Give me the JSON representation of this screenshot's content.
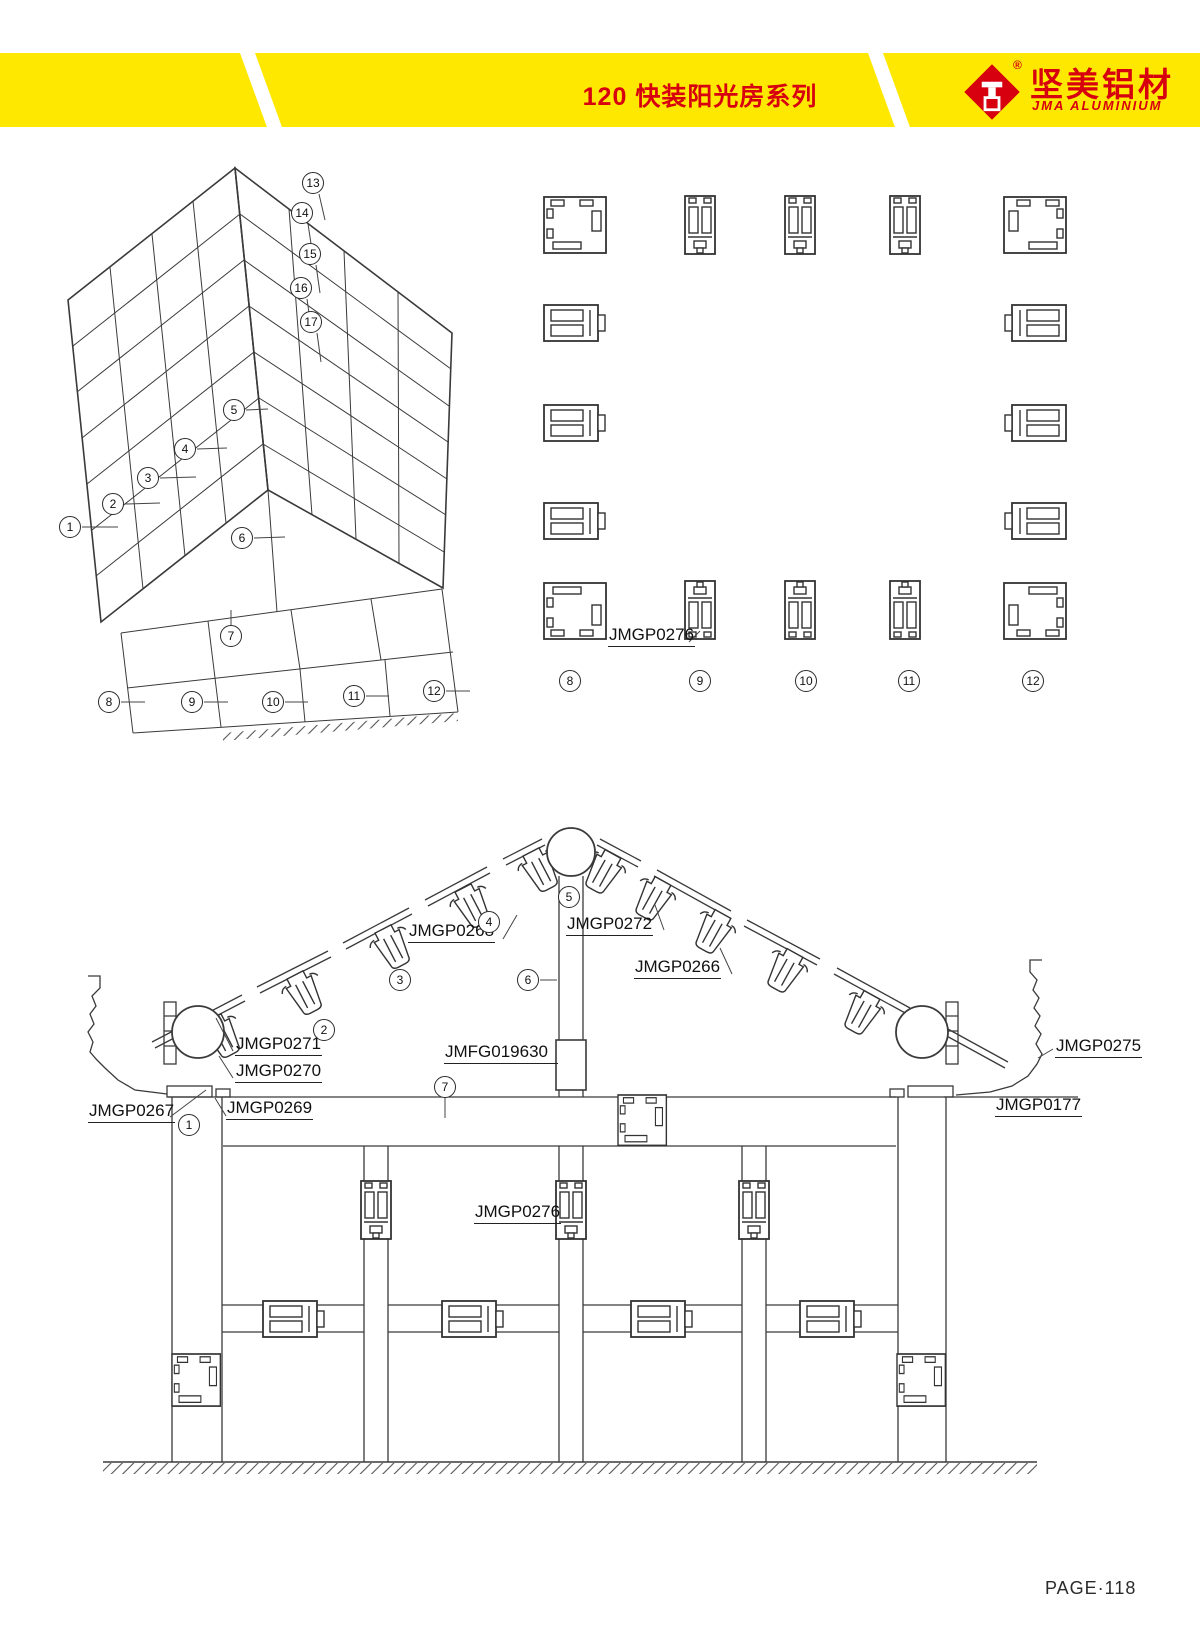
{
  "header": {
    "title": "120 快装阳光房系列",
    "logo": {
      "cn": "坚美铝材",
      "en": "JMA ALUMINIUM",
      "reg": "®"
    }
  },
  "footer": {
    "page": "PAGE·118"
  },
  "colors": {
    "accent_yellow": "#FFE800",
    "brand_red": "#D7000F",
    "line": "#3a3a3a"
  },
  "iso": {
    "callouts": {
      "c1": "1",
      "c2": "2",
      "c3": "3",
      "c4": "4",
      "c5": "5",
      "c6": "6",
      "c7": "7",
      "c8": "8",
      "c9": "9",
      "c10": "10",
      "c11": "11",
      "c12": "12",
      "c13": "13",
      "c14": "14",
      "c15": "15",
      "c16": "16",
      "c17": "17"
    }
  },
  "plan": {
    "part_label": "JMGP0276",
    "callouts": {
      "c8": "8",
      "c9": "9",
      "c10": "10",
      "c11": "11",
      "c12": "12"
    }
  },
  "section": {
    "labels": {
      "jmgp0268": "JMGP0268",
      "jmgp0272": "JMGP0272",
      "jmgp0266": "JMGP0266",
      "jmgp0271": "JMGP0271",
      "jmgp0270": "JMGP0270",
      "jmgp0267": "JMGP0267",
      "jmgp0269": "JMGP0269",
      "jmfg019630": "JMFG019630",
      "jmgp0275": "JMGP0275",
      "jmgp0177": "JMGP0177",
      "jmgp0276": "JMGP0276"
    },
    "callouts": {
      "c1": "1",
      "c2": "2",
      "c3": "3",
      "c4": "4",
      "c5": "5",
      "c6": "6",
      "c7": "7"
    }
  }
}
